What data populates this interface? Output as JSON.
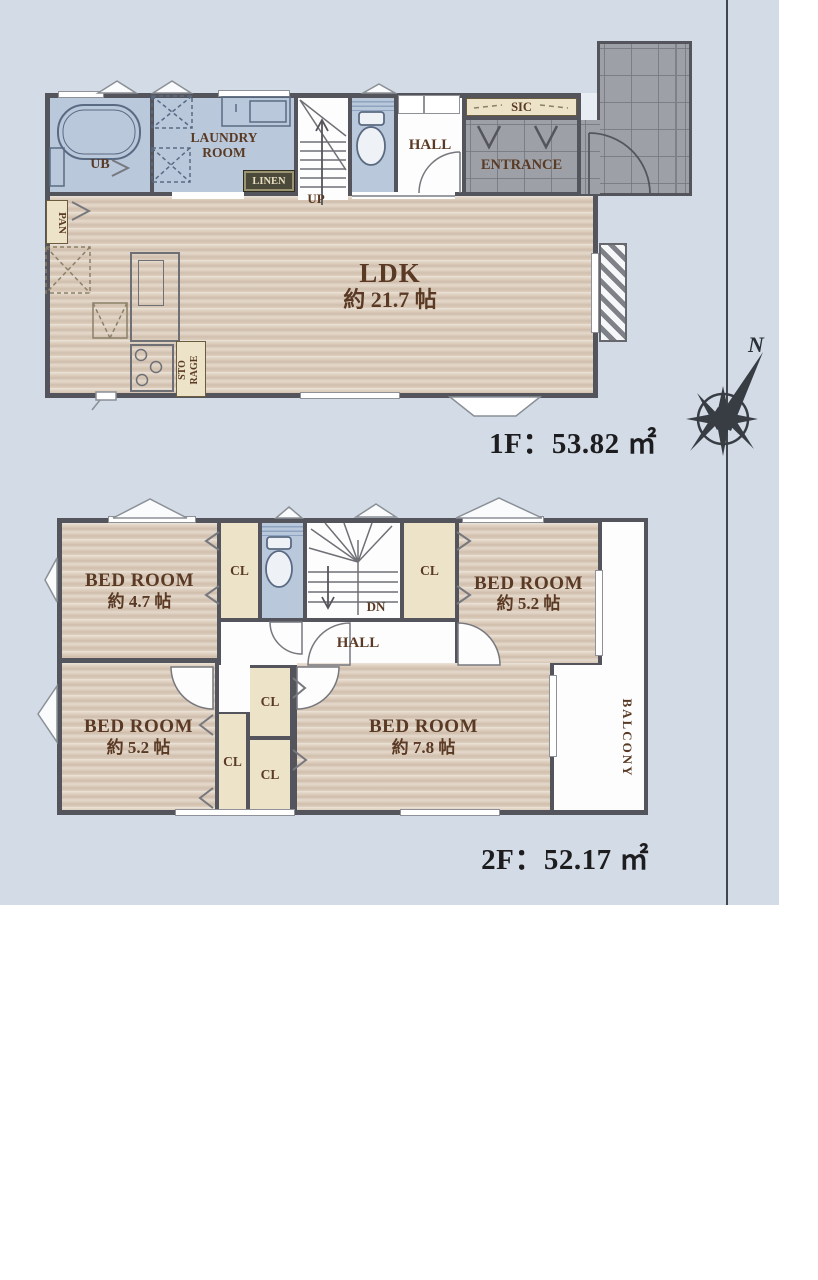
{
  "colors": {
    "wall": "#54555c",
    "wood_floor": "#decfbf",
    "wet_room_blue": "#b9c8db",
    "closet_cream": "#ece3c8",
    "tile_gray": "#9da1a7",
    "hall_white": "#fdfdfd",
    "label_brown": "#5a3a24",
    "label_black": "#1d1d1f",
    "background_top": "#f2f5f9",
    "background_bottom": "#c6d1df",
    "linen_bg": "#4b4939",
    "linen_text": "#e8dfc0"
  },
  "floor1": {
    "area_label": "1F：53.82 ㎡",
    "ub": "UB",
    "laundry_line1": "LAUNDRY",
    "laundry_line2": "ROOM",
    "linen": "LINEN",
    "up": "UP",
    "hall": "HALL",
    "entrance": "ENTRANCE",
    "sic": "SIC",
    "pan": "PAN",
    "storage_line1": "STO",
    "storage_line2": "RAGE",
    "ldk": "LDK",
    "ldk_size": "約 21.7 帖"
  },
  "floor2": {
    "area_label": "2F：52.17 ㎡",
    "closet": "CL",
    "hall": "HALL",
    "down": "DN",
    "balcony": "BALCONY",
    "bedrooms": [
      {
        "name": "BED ROOM",
        "size": "約 4.7 帖"
      },
      {
        "name": "BED ROOM",
        "size": "約 5.2 帖"
      },
      {
        "name": "BED ROOM",
        "size": "約 5.2 帖"
      },
      {
        "name": "BED ROOM",
        "size": "約 7.8 帖"
      }
    ]
  },
  "compass": {
    "north": "N"
  }
}
